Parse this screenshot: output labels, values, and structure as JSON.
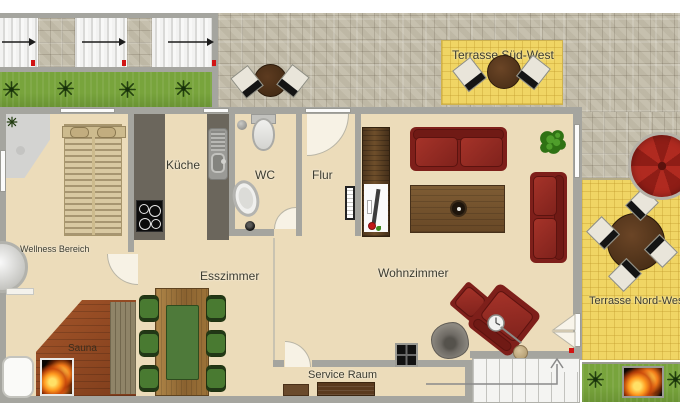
{
  "plan": {
    "type": "residential-floor-plan",
    "labels": {
      "wellness": "Wellness Bereich",
      "sauna": "Sauna",
      "kueche": "Küche",
      "wc": "WC",
      "flur": "Flur",
      "esszimmer": "Esszimmer",
      "wohnzimmer": "Wohnzimmer",
      "service": "Service Raum",
      "terrasse_sued_west": "Terrasse Süd-West",
      "terrasse_nord_west": "Terrasse Nord-West"
    },
    "colors": {
      "floor_beige": "#ecdcba",
      "wall_gray": "#a5a59f",
      "terrace_yellow": "#f0d564",
      "grass_green": "#78a43c",
      "pavement_gray": "#c6c0ae",
      "sofa_red": "#8e2822",
      "dining_chair_green": "#497a31",
      "wood_brown": "#8a5a2e",
      "umbrella_red": "#b02a20",
      "marker_red": "#d11414"
    },
    "icons": {
      "plant_icon": "starburst plant (top view)",
      "flame_icon": "fire / flames",
      "umbrella_icon": "parasol (top view)",
      "direction_arrow_icon": "→",
      "stairs_up_arrow_icon": "↑"
    }
  }
}
